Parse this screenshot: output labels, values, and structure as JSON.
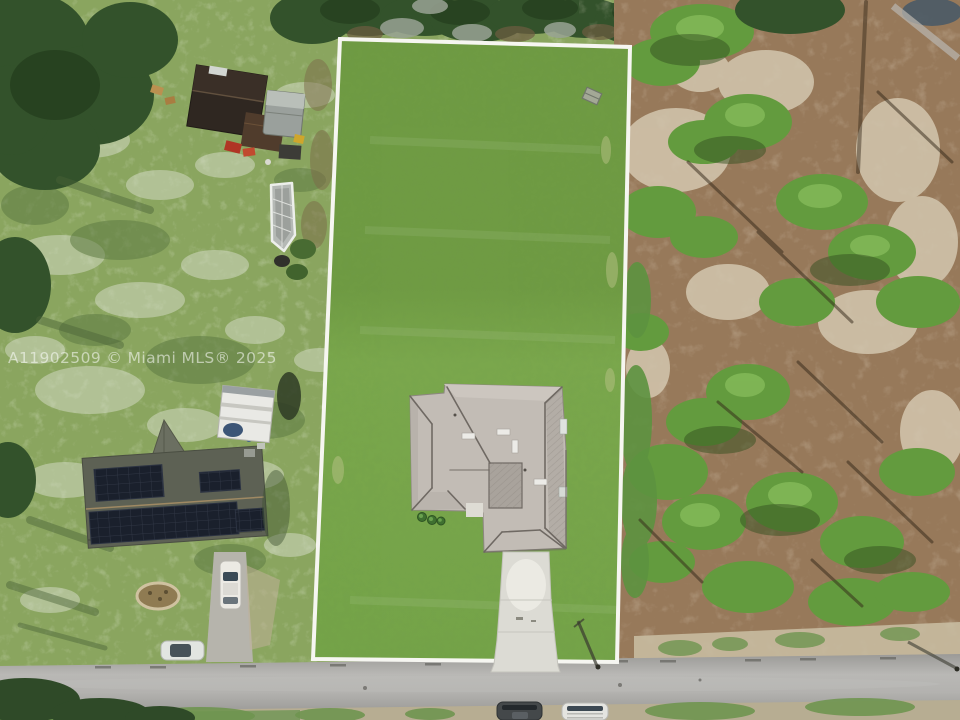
{
  "watermark": {
    "text": "A11902509 © Miami MLS® 2025",
    "color": "#ffffff",
    "opacity": 0.55
  },
  "palette": {
    "weedy_grass": "#8aa55f",
    "lawn_dark": "#6f9b43",
    "lawn_light": "#7aa74c",
    "canopy_green": "#33522b",
    "shrub_green": "#639b3e",
    "forest_ground": "#97795a",
    "sand": "#d3c7af",
    "road_gray": "#9b9a97",
    "road_light": "#b9b8b5",
    "outline_white": "#f6f6f1",
    "roof_gray": "#c2bcb5",
    "roof_ridge": "#6f6963",
    "driveway_concrete": "#dcdbd4",
    "solar_panel": "#1a202c",
    "neighbor_roof": "#5d6154",
    "shed_roof": "#2f2721"
  },
  "scene": {
    "description": "Aerial drone photo of a white-outlined residential lot with mowed lawn, a single-story gray hip-roof house and straight concrete driveway to a street at the bottom; weedy yards and neighboring homes (one with rooftop solar panels, an RV and parked cars, one with a dark shed, truck and screened enclosure) on the left; pine scrub woodland with sandy ground on the right; vehicles parked along the road shoulder.",
    "objects": [
      "white-property-boundary-outline",
      "mowed-lawn-lot",
      "gray-hip-roof-house",
      "concrete-driveway",
      "entry-walkway",
      "foundation-shrubs",
      "utility-marker",
      "street-road",
      "solar-panel-house",
      "rv-trailer",
      "white-car-driveway",
      "white-sedan-roadside",
      "oval-garden-bed",
      "dark-roof-shed",
      "gray-truck",
      "screened-enclosure",
      "pine-woodland",
      "sand-patches",
      "shrub-clusters",
      "pine-trunk-shadows",
      "tree-canopy",
      "utility-pole-shadow",
      "dark-suv-roadside",
      "white-suv-roadside"
    ]
  }
}
